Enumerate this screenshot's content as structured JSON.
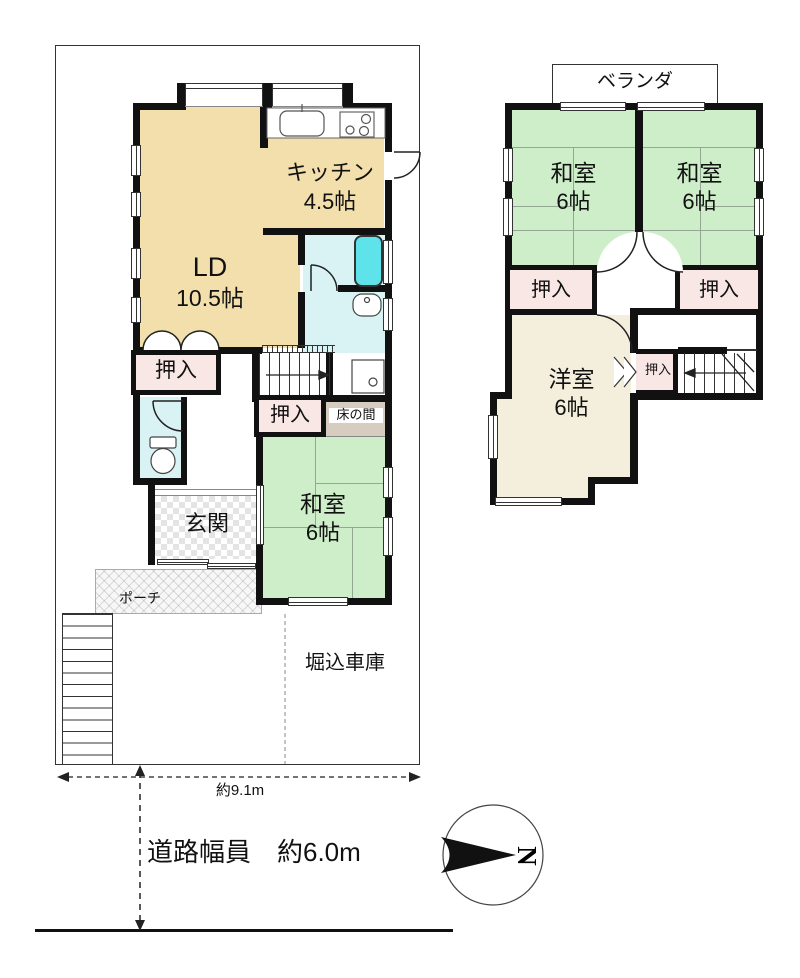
{
  "floor1": {
    "ld": {
      "name": "LD",
      "size": "10.5帖"
    },
    "kitchen": {
      "name": "キッチン",
      "size": "4.5帖"
    },
    "washitsu": {
      "name": "和室",
      "size": "6帖"
    },
    "closet_left": "押入",
    "closet_center": "押入",
    "tokonoma": "床の間",
    "genkan": "玄関",
    "porch": "ポーチ",
    "garage": "堀込車庫"
  },
  "floor2": {
    "veranda": "ベランダ",
    "washitsu_left": {
      "name": "和室",
      "size": "6帖"
    },
    "washitsu_right": {
      "name": "和室",
      "size": "6帖"
    },
    "youshitsu": {
      "name": "洋室",
      "size": "6帖"
    },
    "closet_left": "押入",
    "closet_right": "押入",
    "closet_small": "押入"
  },
  "annotations": {
    "site_width": "約9.1m",
    "road_width": "道路幅員　約6.0m",
    "compass_north": "N"
  },
  "colors": {
    "wall": "#111111",
    "tatami_room": "#cdeec9",
    "wood_room": "#f2dfab",
    "western_room": "#f4efdc",
    "closet": "#f9e7e5",
    "wet_area": "#d9f3f5",
    "bathtub": "#5fe3ea",
    "tokonoma_fill": "#d6ccc0",
    "tatami_line": "#93a893"
  }
}
